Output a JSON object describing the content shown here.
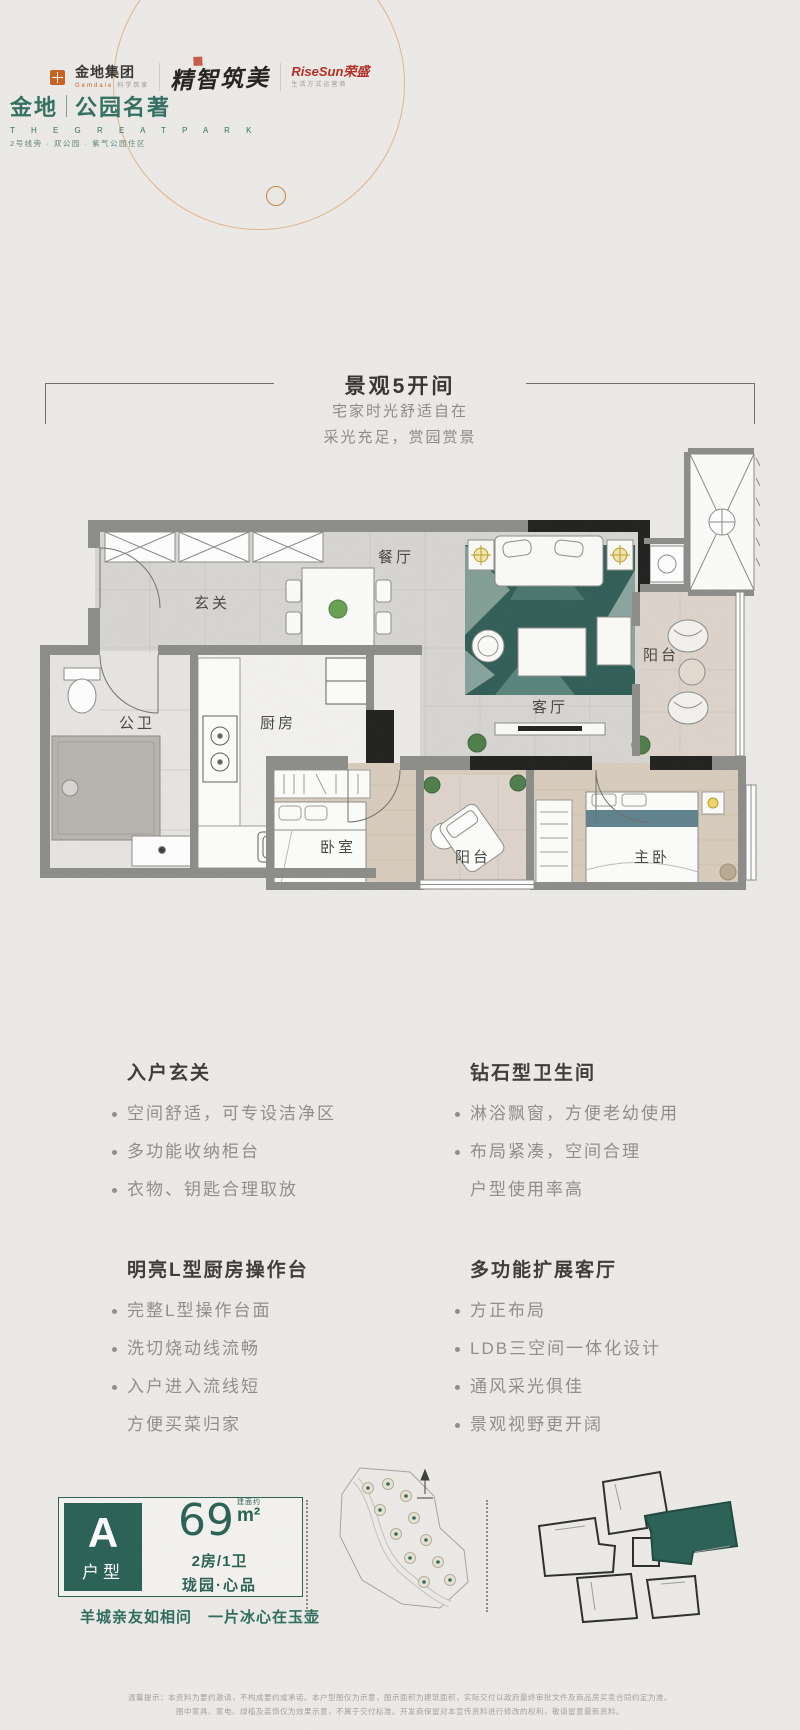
{
  "header": {
    "gemdale": {
      "name": "金地集团",
      "en": "Gemdale",
      "slogan": "科学筑家"
    },
    "calligraphy": "精智筑美",
    "risesun": {
      "name": "RiseSun荣盛",
      "slogan": "生活方式运营商"
    },
    "project": {
      "brand": "金地",
      "name": "公园名著",
      "en": "T H E   G R E A T   P A R K",
      "tagline": "2号线旁 · 双公园 · 紫气公园住区"
    }
  },
  "hero": {
    "title": "景观5开间",
    "subtitle1": "宅家时光舒适自在",
    "subtitle2": "采光充足，赏园赏景"
  },
  "floorplan": {
    "labels": {
      "hall": "玄关",
      "bath": "公卫",
      "kitchen": "厨房",
      "dining": "餐厅",
      "living": "客厅",
      "balcony_right": "阳台",
      "bedroom": "卧室",
      "balcony_bottom": "阳台",
      "master": "主卧"
    }
  },
  "features": [
    {
      "title": "入户玄关",
      "bullets": [
        [
          "空间舒适，可专设洁净区"
        ],
        [
          "多功能收纳柜台"
        ],
        [
          "衣物、钥匙合理取放"
        ]
      ]
    },
    {
      "title": "钻石型卫生间",
      "bullets": [
        [
          "淋浴飘窗，方便老幼使用"
        ],
        [
          "布局紧凑，空间合理",
          "户型使用率高"
        ]
      ]
    },
    {
      "title": "明亮L型厨房操作台",
      "bullets": [
        [
          "完整L型操作台面"
        ],
        [
          "洗切烧动线流畅"
        ],
        [
          "入户进入流线短",
          "方便买菜归家"
        ]
      ]
    },
    {
      "title": "多功能扩展客厅",
      "bullets": [
        [
          "方正布局"
        ],
        [
          "LDB三空间一体化设计"
        ],
        [
          "通风采光俱佳"
        ],
        [
          "景观视野更开阔"
        ]
      ]
    }
  ],
  "unit": {
    "letter": "A",
    "type_label": "户型",
    "area_note": "建面约",
    "area_value": "69",
    "area_unit": "m²",
    "spec": "2房/1卫",
    "product": "珑园·心品",
    "poem": "羊城亲友如相问　一片冰心在玉壶"
  },
  "colors": {
    "brand_teal": "#275f53",
    "accent_orange": "#c8601c",
    "rug_teal": "#2e5c55"
  },
  "footer": {
    "line1": "温馨提示：本资料为要约邀请，不构成要约或承诺。本户型图仅为示意，图示面积为建筑面积，实际交付以政府最终审批文件及商品房买卖合同约定为准。",
    "line2": "图中家具、家电、绿植及装饰仅为效果示意，不属于交付标准。开发商保留对本宣传资料进行修改的权利，敬请留意最新资料。"
  }
}
